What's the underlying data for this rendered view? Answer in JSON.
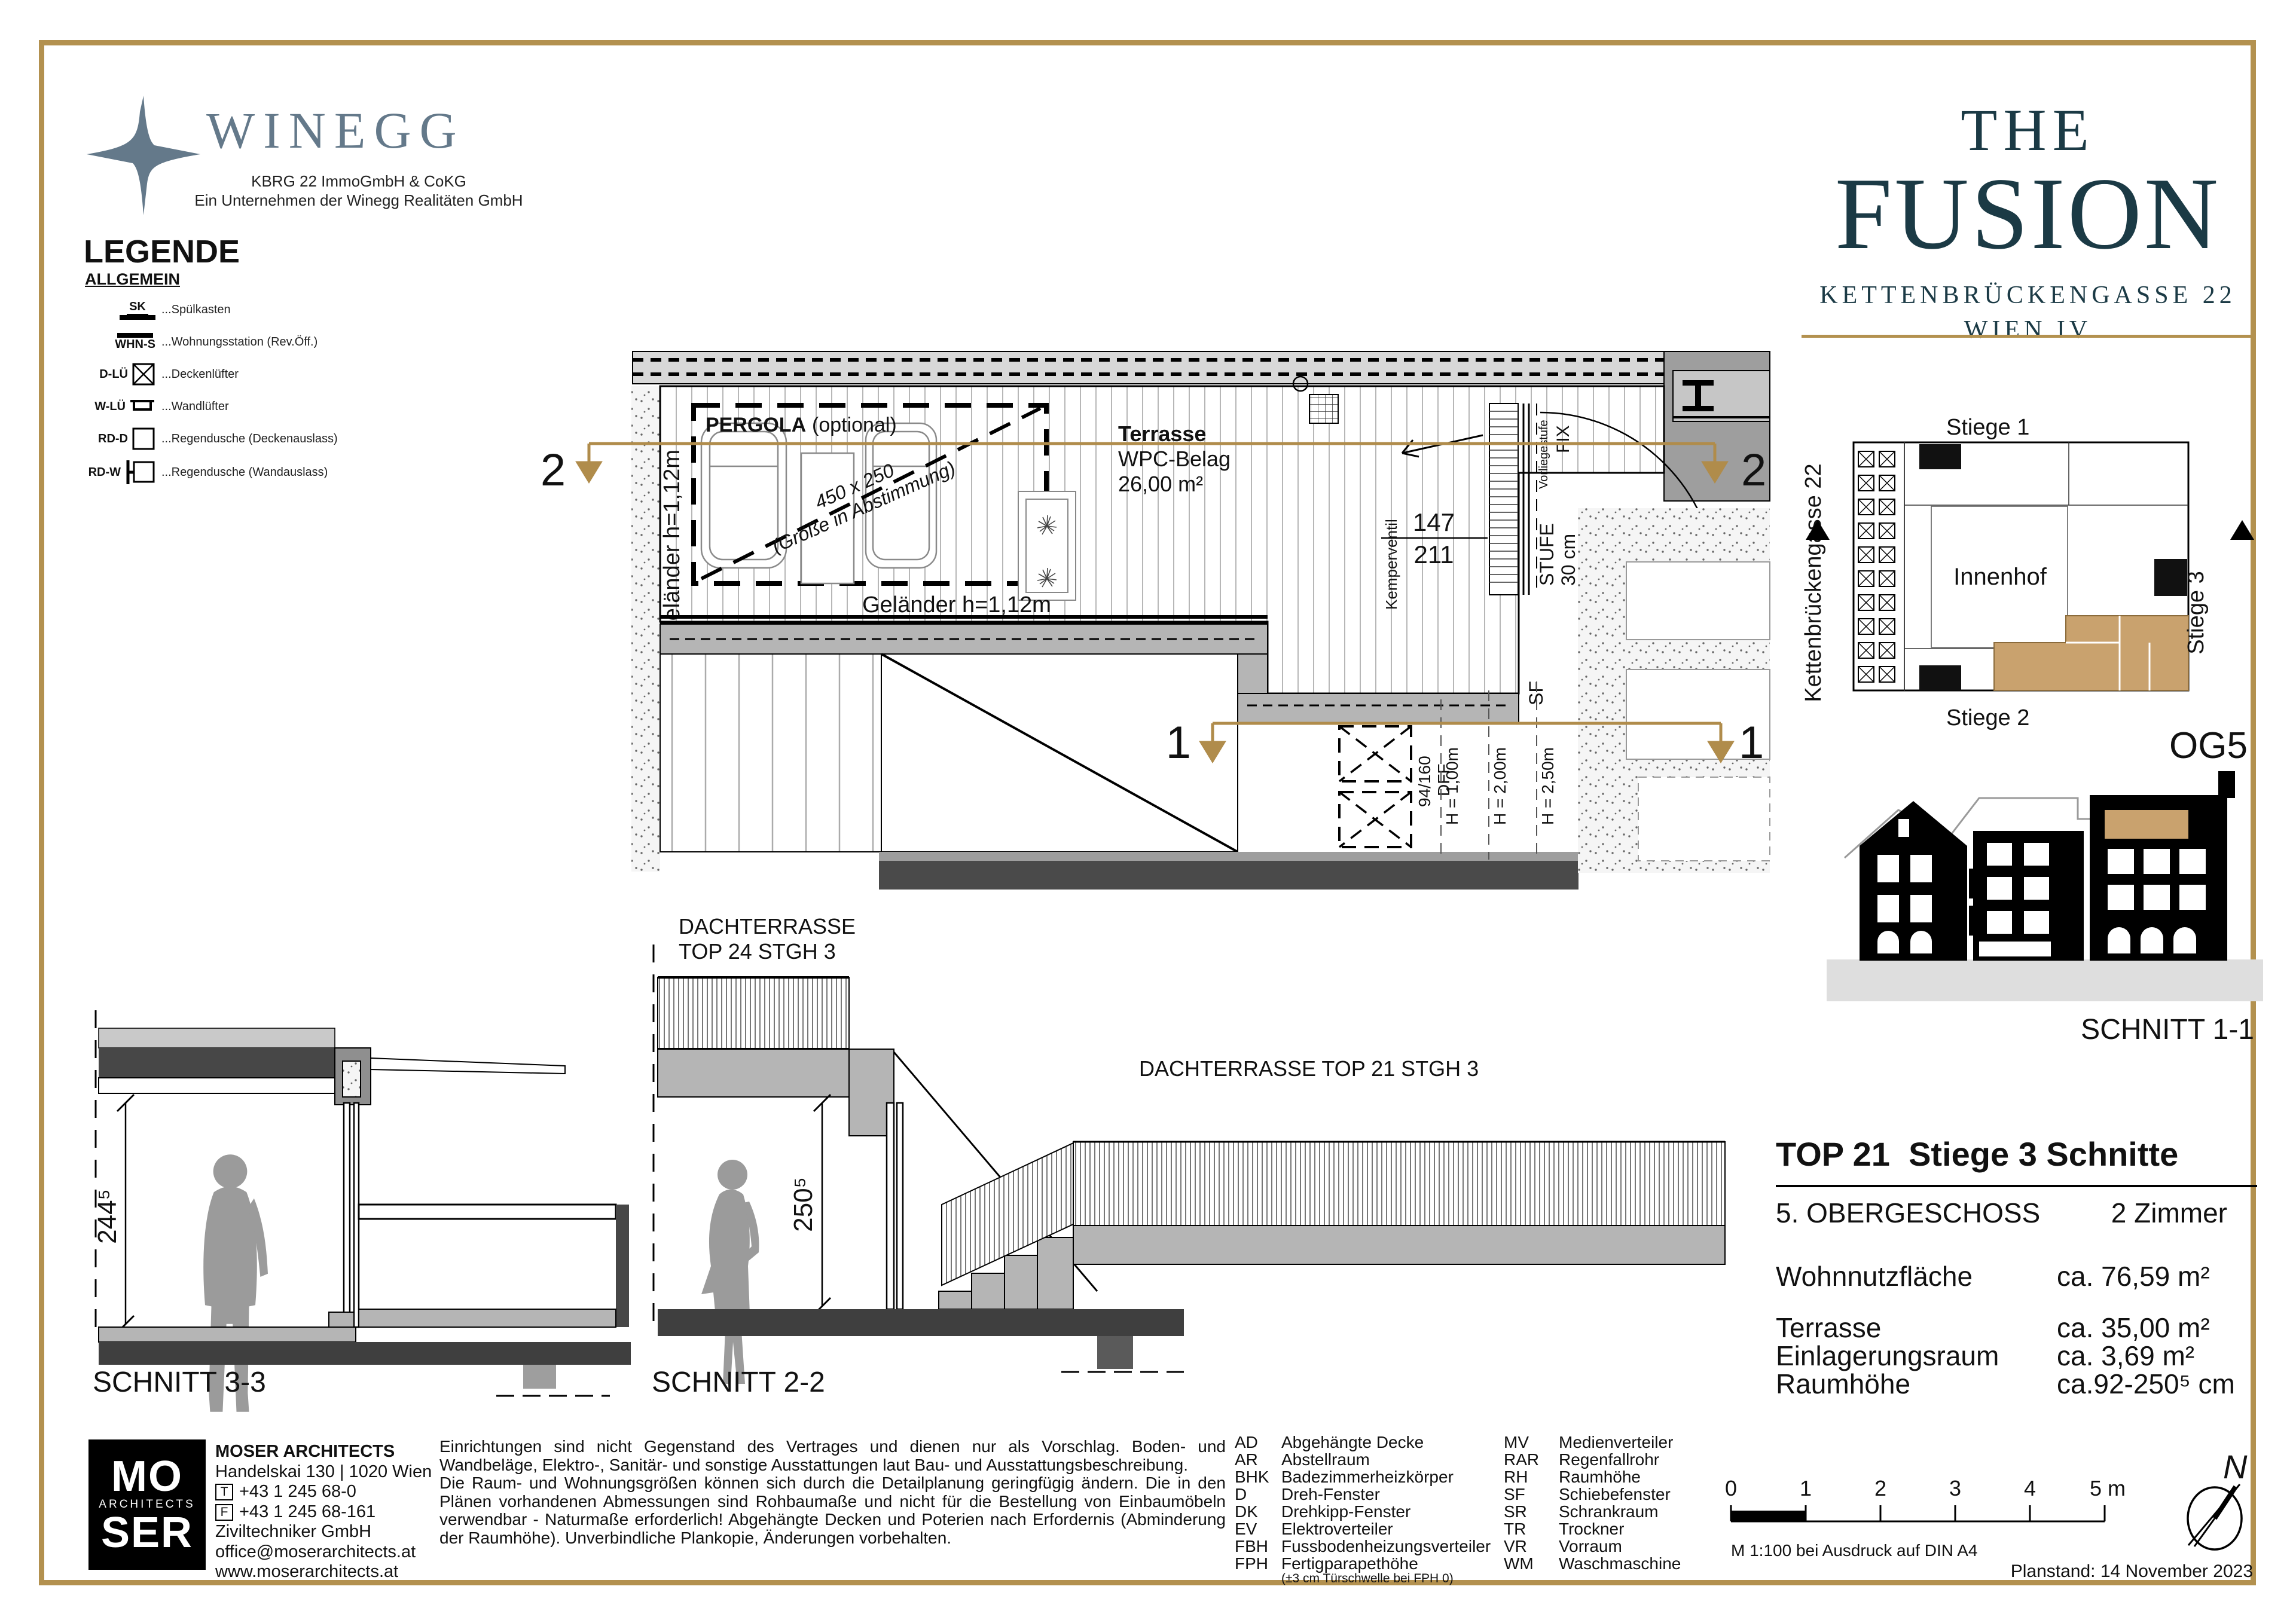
{
  "colors": {
    "gold": "#b3914f",
    "tan": "#c9a26e",
    "teal": "#1b3a45",
    "bluegray": "#64798a"
  },
  "branding": {
    "winegg_name": "WINEGG",
    "winegg_sub1": "KBRG 22 ImmoGmbH & CoKG",
    "winegg_sub2": "Ein Unternehmen der Winegg Realitäten GmbH",
    "fusion_the": "THE",
    "fusion_name": "FUSION",
    "fusion_street": "KETTENBRÜCKENGASSE 22",
    "fusion_city": "WIEN IV"
  },
  "legend": {
    "title": "LEGENDE",
    "group": "ALLGEMEIN",
    "items": [
      {
        "code": "SK",
        "label": "...Spülkasten"
      },
      {
        "code": "WHN-S",
        "label": "...Wohnungsstation (Rev.Öff.)"
      },
      {
        "code": "D-LÜ",
        "label": "...Deckenlüfter"
      },
      {
        "code": "W-LÜ",
        "label": "...Wandlüfter"
      },
      {
        "code": "RD-D",
        "label": "...Regendusche (Deckenauslass)"
      },
      {
        "code": "RD-W",
        "label": "...Regendusche (Wandauslass)"
      }
    ]
  },
  "plan": {
    "pergola": "PERGOLA",
    "pergola_opt": "(optional)",
    "size_note_1": "450 x 250",
    "size_note_2": "(Größe in Abstimmung)",
    "terrasse": "Terrasse",
    "belag": "WPC-Belag",
    "area": "26,00 m²",
    "gelaender_left": "Geländer h=1,12m",
    "gelaender_bottom": "Geländer h=1,12m",
    "dim_top": "147",
    "dim_bottom": "211",
    "kemperventil": "Kemperventil",
    "vorliegestufe": "Vorliegestufe",
    "fix": "FIX",
    "stufe": "STUFE",
    "stufe_cm": "30 cm",
    "sf": "SF",
    "dff_size": "94/160",
    "dff": "DFF",
    "h1": "H = 1,00m",
    "h2": "H = 2,00m",
    "h3": "H = 2,50m"
  },
  "markers": {
    "s1": "1",
    "s2": "2"
  },
  "key_plan": {
    "stiege1": "Stiege 1",
    "stiege2": "Stiege 2",
    "stiege3": "Stiege 3",
    "street": "Kettenbrückengasse 22",
    "innenhof": "Innenhof",
    "og": "OG5"
  },
  "sections": {
    "s11": "SCHNITT 1-1",
    "s33": "SCHNITT 3-3",
    "s22": "SCHNITT 2-2",
    "dim33": "244⁵",
    "dim22": "250⁵",
    "dach24_line1": "DACHTERRASSE",
    "dach24_line2": "TOP 24 STGH 3",
    "dach21": "DACHTERRASSE TOP 21 STGH 3"
  },
  "info": {
    "title_no": "TOP 21",
    "title_rest": "Stiege 3 Schnitte",
    "floor": "5. OBERGESCHOSS",
    "rooms": "2 Zimmer",
    "rows": [
      {
        "label": "Wohnnutzfläche",
        "value": "ca. 76,59 m²"
      },
      {
        "label": "Terrasse",
        "value": "ca. 35,00 m²"
      },
      {
        "label": "Einlagerungsraum",
        "value": "ca. 3,69 m²"
      },
      {
        "label": "Raumhöhe",
        "value": "ca.92-250⁵ cm"
      }
    ]
  },
  "footer": {
    "moser_mo": "MO",
    "moser_architects": "ARCHITECTS",
    "moser_ser": "SER",
    "firm": "MOSER ARCHITECTS",
    "address": "Handelskai 130 | 1020 Wien",
    "tel_icon": "T",
    "tel": "+43 1 245 68-0",
    "fax_icon": "F",
    "fax": "+43 1 245 68-161",
    "company": "Ziviltechniker GmbH",
    "email": "office@moserarchitects.at",
    "web": "www.moserarchitects.at",
    "disclaimer1": "Einrichtungen sind nicht Gegenstand des Vertrages und dienen nur als Vorschlag. Boden- und Wandbeläge, Elektro-, Sanitär- und sonstige Ausstattungen laut Bau- und Ausstattungsbeschreibung.",
    "disclaimer2": "Die Raum- und Wohnungsgrößen können sich durch die Detailplanung geringfügig ändern. Die in den Plänen vorhandenen Abmessungen sind Rohbaumaße und nicht für die Bestellung von Einbaumöbeln verwendbar - Naturmaße erforderlich! Abgehängte Decken und Poterien nach Erfordernis (Abminderung der Raumhöhe). Unverbindliche Plankopie, Änderungen vorbehalten.",
    "abbr_col1": [
      {
        "k": "AD",
        "v": "Abgehängte Decke"
      },
      {
        "k": "AR",
        "v": "Abstellraum"
      },
      {
        "k": "BHK",
        "v": "Badezimmerheizkörper"
      },
      {
        "k": "D",
        "v": "Dreh-Fenster"
      },
      {
        "k": "DK",
        "v": "Drehkipp-Fenster"
      },
      {
        "k": "EV",
        "v": "Elektroverteiler"
      },
      {
        "k": "FBH",
        "v": "Fussbodenheizungsverteiler"
      },
      {
        "k": "FPH",
        "v": "Fertigparapethöhe"
      }
    ],
    "abbr_note": "(±3 cm Türschwelle bei FPH 0)",
    "abbr_col2": [
      {
        "k": "MV",
        "v": "Medienverteiler"
      },
      {
        "k": "RAR",
        "v": "Regenfallrohr"
      },
      {
        "k": "RH",
        "v": "Raumhöhe"
      },
      {
        "k": "SF",
        "v": "Schiebefenster"
      },
      {
        "k": "SR",
        "v": "Schrankraum"
      },
      {
        "k": "TR",
        "v": "Trockner"
      },
      {
        "k": "VR",
        "v": "Vorraum"
      },
      {
        "k": "WM",
        "v": "Waschmaschine"
      }
    ],
    "scale_ticks": [
      "0",
      "1",
      "2",
      "3",
      "4",
      "5 m"
    ],
    "scale_note": "M 1:100 bei Ausdruck auf DIN A4",
    "north": "N",
    "planstand": "Planstand: 14 November 2023"
  }
}
